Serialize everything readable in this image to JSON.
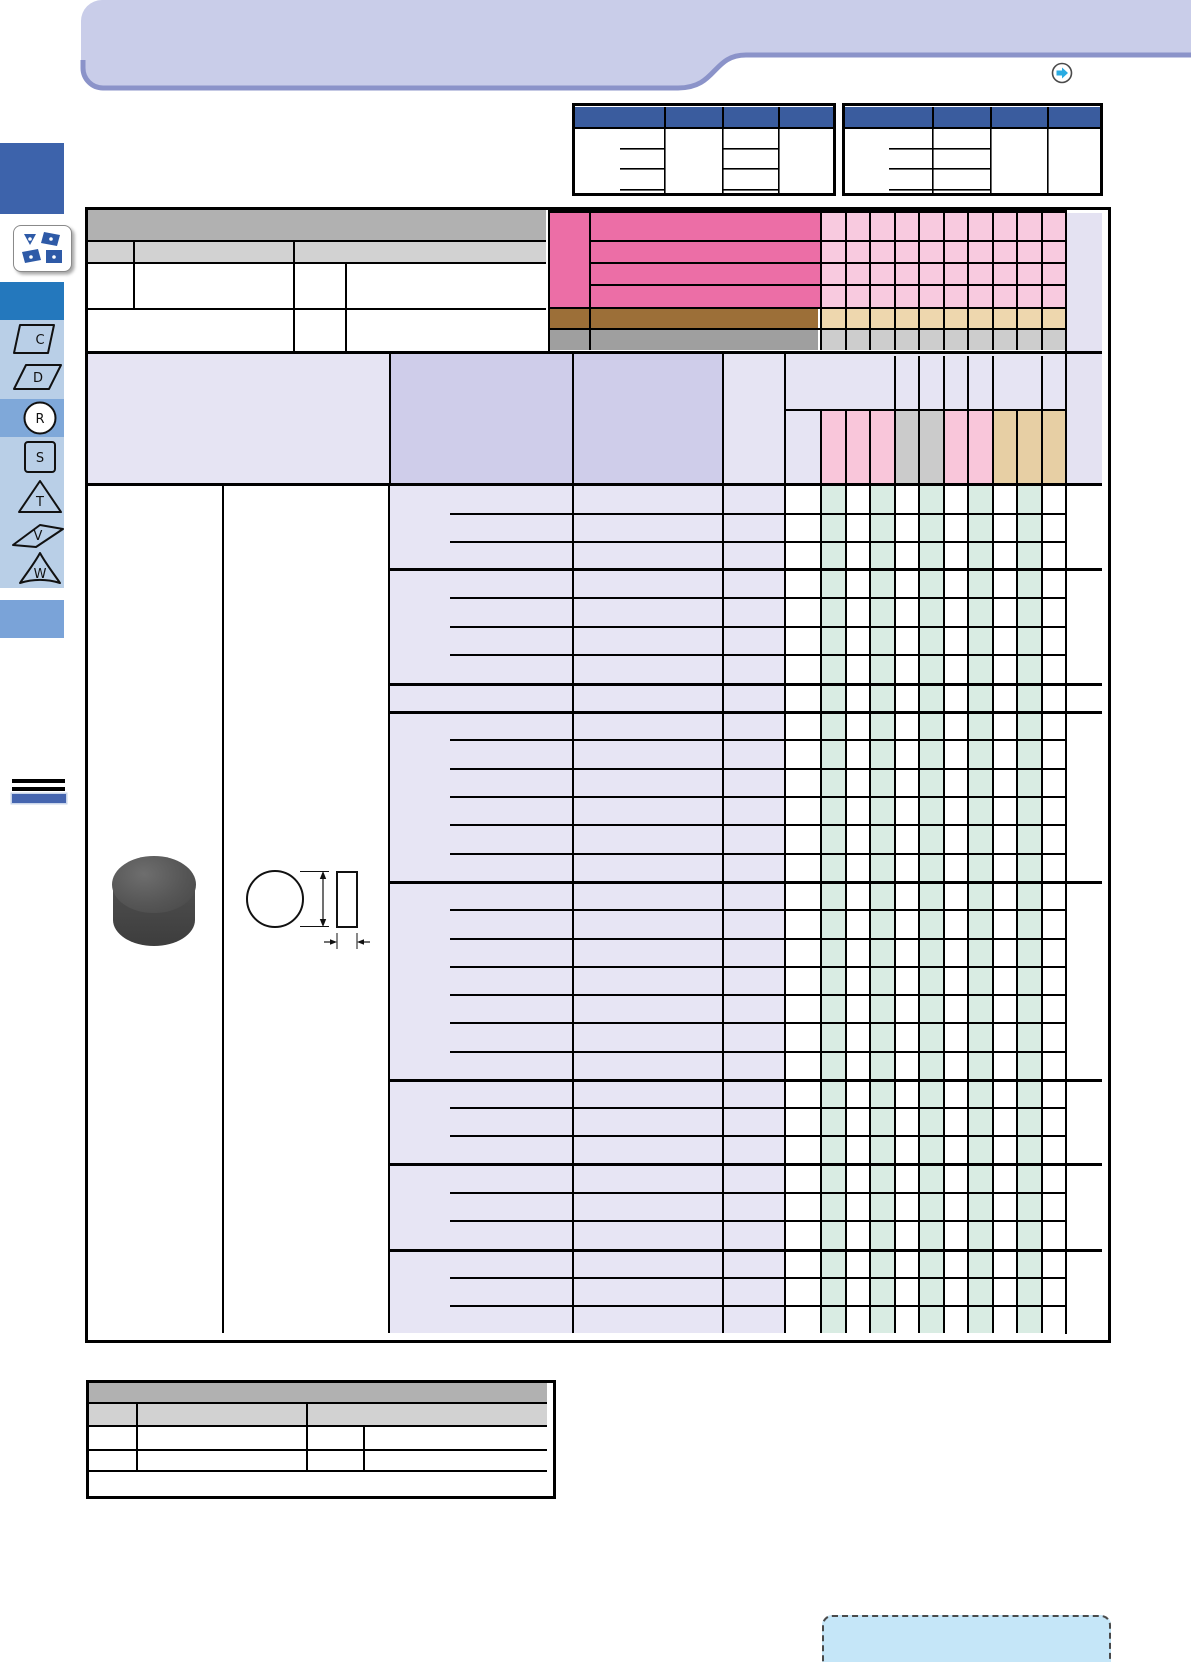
{
  "page": {
    "width": 1191,
    "height": 1662,
    "background": "#ffffff"
  },
  "header_band": {
    "fill": "#c9cde9",
    "underline_color": "#8b93c9",
    "nav_icon": "circle-arrow-right-icon",
    "nav_arrow_color": "#29abe2"
  },
  "sidebar": {
    "top_block_color": "#3d63ab",
    "category_tile_icon": "turning-inserts-icon",
    "tile_shape_color": "#2e5aa7",
    "mid_block_color": "#2478bd",
    "strip_color": "#b9cfe7",
    "active_row_color": "#7fa8d9",
    "bottom_block_color": "#7aa3d8",
    "tabs": [
      {
        "label": "C",
        "shape": "square-skewed",
        "active": false
      },
      {
        "label": "D",
        "shape": "parallelogram",
        "active": false
      },
      {
        "label": "R",
        "shape": "circle",
        "active": true
      },
      {
        "label": "S",
        "shape": "square",
        "active": false
      },
      {
        "label": "T",
        "shape": "triangle",
        "active": false
      },
      {
        "label": "V",
        "shape": "rhombus-thin",
        "active": false
      },
      {
        "label": "W",
        "shape": "trigon",
        "active": false
      }
    ],
    "section_marker": {
      "line_color": "#000000",
      "bar_color": "#4565af"
    }
  },
  "top_tables": {
    "header_color": "#3a5c9e",
    "left": {
      "columns": 4,
      "detail_rows": 3
    },
    "right": {
      "columns": 4,
      "detail_rows": 3
    }
  },
  "main_table": {
    "header": {
      "band1_color": "#b1b1b1",
      "band2_color": "#d2d2d2",
      "pink_strong": "#ec6ea6",
      "pink_light": "#f8cadf",
      "brown": "#9c6f38",
      "tan": "#eed7ae",
      "gray_dark": "#9f9f9f",
      "gray_light": "#cdcdcd",
      "right_col_color": "#e4e2f2",
      "pink_rows": 4,
      "small_columns": 10
    },
    "subheader": {
      "light": "#e6e4f3",
      "medium": "#cfcdea",
      "merged_top_spans": [
        3,
        1,
        1,
        1,
        1,
        2,
        1
      ],
      "cell_colors": [
        "#f9c6da",
        "#f9c6da",
        "#f9c6da",
        "#cbcbcb",
        "#cbcbcb",
        "#f9c6da",
        "#f9c6da",
        "#e7cfa4",
        "#e7cfa4",
        "#e7cfa4"
      ]
    },
    "body": {
      "row_band_color": "#e7e5f4",
      "stripe_color": "#d9ece3",
      "stripe_columns": [
        0,
        2,
        4,
        6,
        8
      ],
      "groups": [
        {
          "rows": 3
        },
        {
          "rows": 4
        },
        {
          "rows": 1
        },
        {
          "rows": 6
        },
        {
          "rows": 7
        },
        {
          "rows": 3
        },
        {
          "rows": 3
        },
        {
          "rows": 3
        }
      ]
    },
    "product": {
      "photo": "round-insert-photo",
      "drawing": "round-insert-dimension-drawing"
    }
  },
  "bottom_table": {
    "band1_color": "#b1b1b1",
    "band2_color": "#d2d2d2"
  },
  "note_box": {
    "fill": "#c5e6f8",
    "border_style": "dashed"
  }
}
